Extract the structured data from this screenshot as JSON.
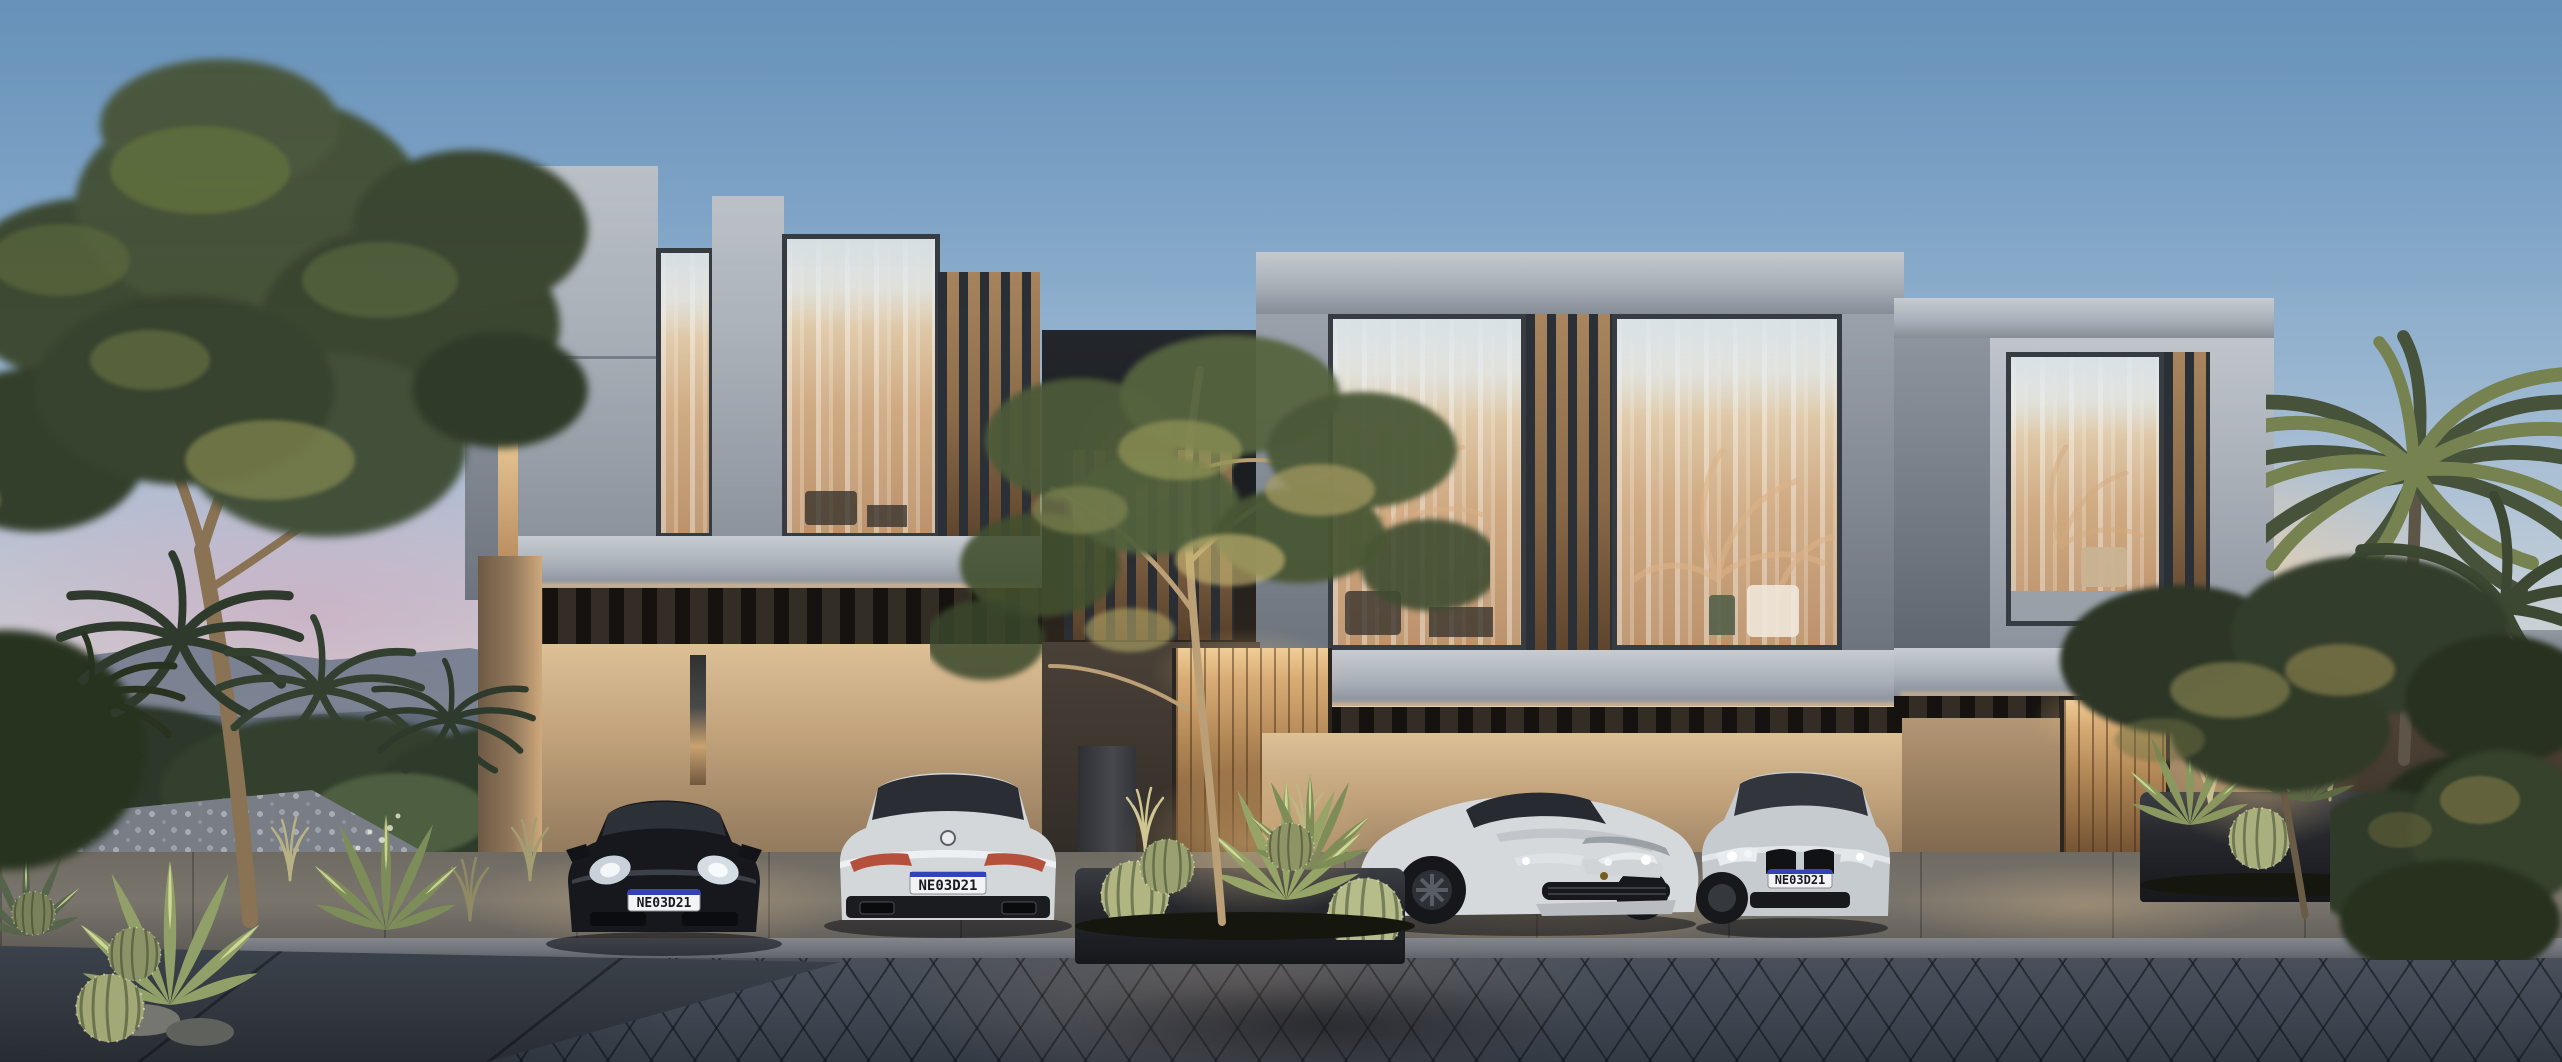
{
  "scene": {
    "license_plates": {
      "porsche": "NE03D21",
      "bmw_white": "NE03D21",
      "bmw_silver": "NE03D21"
    },
    "objects": {
      "car_1": "black-porsche-911-front",
      "car_2": "white-bmw-8-series-coupe-rear",
      "car_3": "white-ferrari-f12-front-quarter",
      "car_4": "silver-bmw-8-series-coupe-front",
      "buildings": "three-modern-grey-townhouse-boxes",
      "time_of_day": "dusk"
    },
    "palette": {
      "sky_top": "#6d99c2",
      "sky_horizon_glow": "#f9cf99",
      "dusk_pink": "#cba2bc",
      "concrete_light": "#c0c5cc",
      "concrete_dark": "#8c939c",
      "window_frame": "#373c43",
      "interior_warm": "#cda67c",
      "wall_beige": "#c2a37c",
      "wood_door": "#b08655",
      "louver_dark": "#2b3036",
      "paver_dark": "#3e4550",
      "foliage_dark": "#3e4a33",
      "foliage_lit": "#bfae66",
      "plate_blue": "#3242b8"
    }
  }
}
